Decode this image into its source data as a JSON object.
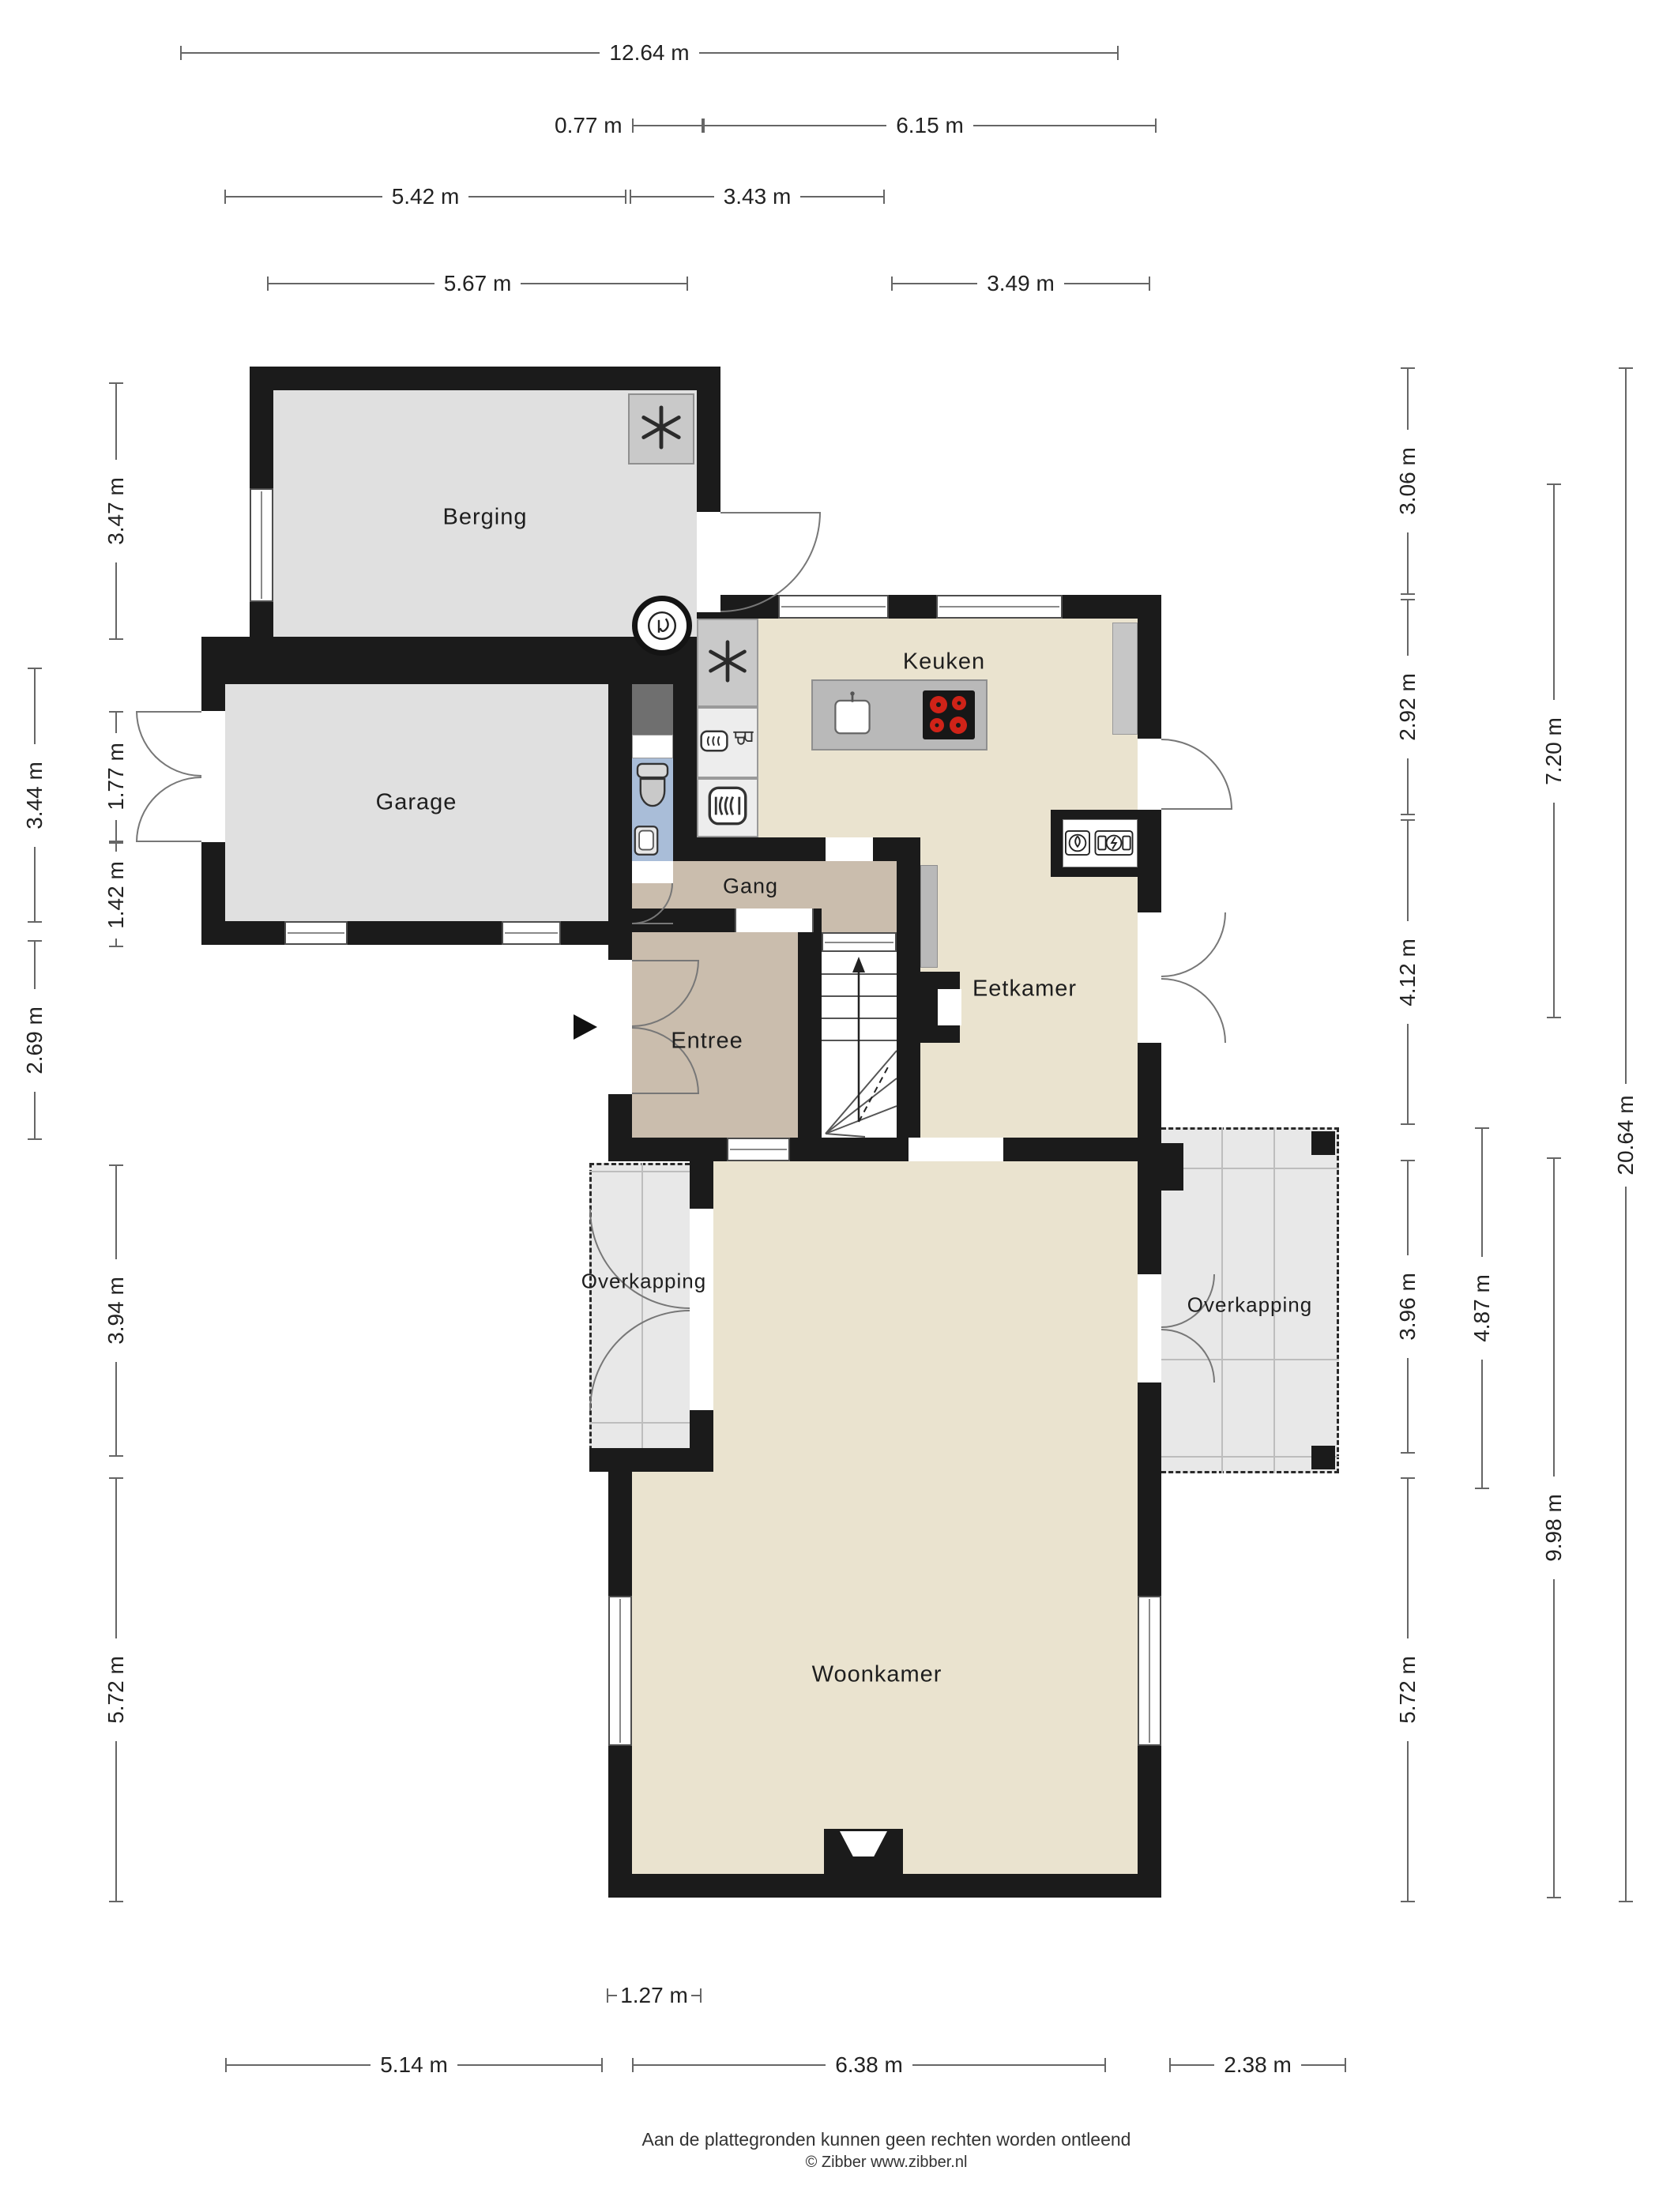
{
  "rooms": {
    "berging": "Berging",
    "garage": "Garage",
    "gang": "Gang",
    "entree": "Entree",
    "keuken": "Keuken",
    "eetkamer": "Eetkamer",
    "woonkamer": "Woonkamer",
    "overkapping_left": "Overkapping",
    "overkapping_right": "Overkapping"
  },
  "dims": {
    "top": [
      "12.64 m",
      "0.77 m",
      "6.15 m",
      "5.42 m",
      "3.43 m",
      "5.67 m",
      "3.49 m"
    ],
    "bottom": [
      "1.27 m",
      "5.14 m",
      "6.38 m",
      "2.38 m"
    ],
    "left": [
      "3.47 m",
      "1.77 m",
      "1.42 m",
      "3.44 m",
      "2.69 m",
      "3.94 m",
      "5.72 m"
    ],
    "right": [
      "3.06 m",
      "2.92 m",
      "4.12 m",
      "3.96 m",
      "5.72 m",
      "4.87 m",
      "7.20 m",
      "9.98 m",
      "20.64 m"
    ]
  },
  "footer": {
    "line1": "Aan de plattegronden kunnen geen rechten worden ontleend",
    "line2": "© Zibber www.zibber.nl"
  },
  "colors": {
    "wall": "#1b1b1b",
    "floor_storage": "#e0e0e0",
    "floor_living": "#eae3cf",
    "floor_hall": "#cabdad",
    "floor_toilet": "#a9bdd8",
    "floor_canopy": "#e8e8e8",
    "kitchen_island": "#b9b9b9",
    "burner_red": "#cf2318",
    "dimension_line": "#666666"
  },
  "icons": [
    "ventilation-fan-icon",
    "boiler-icon",
    "microwave-icon",
    "coffee-machine-icon",
    "oven-icon",
    "kitchen-sink-icon",
    "cooktop-icon",
    "toilet-icon",
    "washbasin-icon",
    "lamp-meter-icon",
    "electric-meter-icon",
    "stairs-up-arrow-icon",
    "entrance-arrow-icon"
  ]
}
